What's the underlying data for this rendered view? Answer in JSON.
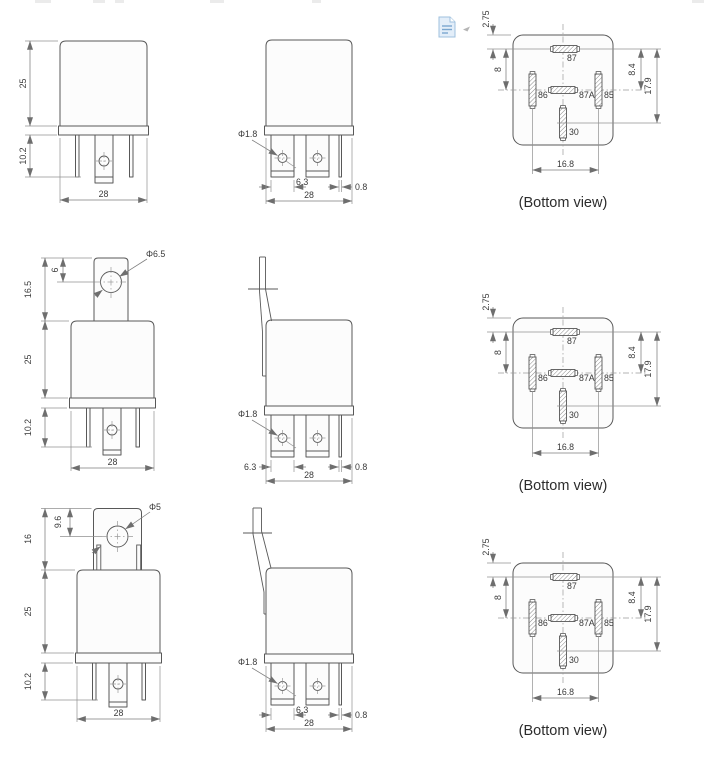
{
  "rows": [
    {
      "front": {
        "body_height": "25",
        "pin_length": "10.2",
        "width": "28"
      },
      "side": {
        "hole_diameter": "Φ1.8",
        "blade_width": "6.3",
        "thin_blade_width": "0.8",
        "width": "28"
      },
      "bottom": {
        "pin_offset_top": "2.75",
        "gap_left": "8",
        "gap_right": "8.4",
        "pin_span_height": "17.9",
        "pin_span_width": "16.8",
        "pin_top": "87",
        "pin_middle": "87A",
        "pin_left": "86",
        "pin_right": "85",
        "pin_bottom": "30",
        "caption": "(Bottom view)"
      }
    },
    {
      "front": {
        "hole_diameter": "Φ6.5",
        "hole_offset": "6",
        "bracket_height": "16.5",
        "body_height": "25",
        "pin_length": "10.2",
        "width": "28"
      },
      "side": {
        "hole_diameter": "Φ1.8",
        "blade_width": "6.3",
        "thin_blade_width": "0.8",
        "width": "28"
      },
      "bottom": {
        "pin_offset_top": "2.75",
        "gap_left": "8",
        "gap_right": "8.4",
        "pin_span_height": "17.9",
        "pin_span_width": "16.8",
        "pin_top": "87",
        "pin_middle": "87A",
        "pin_left": "86",
        "pin_right": "85",
        "pin_bottom": "30",
        "caption": "(Bottom view)"
      }
    },
    {
      "front": {
        "hole_diameter": "Φ5",
        "hole_offset": "9.6",
        "bracket_height": "16",
        "body_height": "25",
        "pin_length": "10.2",
        "width": "28"
      },
      "side": {
        "hole_diameter": "Φ1.8",
        "blade_width": "6.3",
        "thin_blade_width": "0.8",
        "width": "28"
      },
      "bottom": {
        "pin_offset_top": "2.75",
        "gap_left": "8",
        "gap_right": "8.4",
        "pin_span_height": "17.9",
        "pin_span_width": "16.8",
        "pin_top": "87",
        "pin_middle": "87A",
        "pin_left": "86",
        "pin_right": "85",
        "pin_bottom": "30",
        "caption": "(Bottom view)"
      }
    }
  ]
}
